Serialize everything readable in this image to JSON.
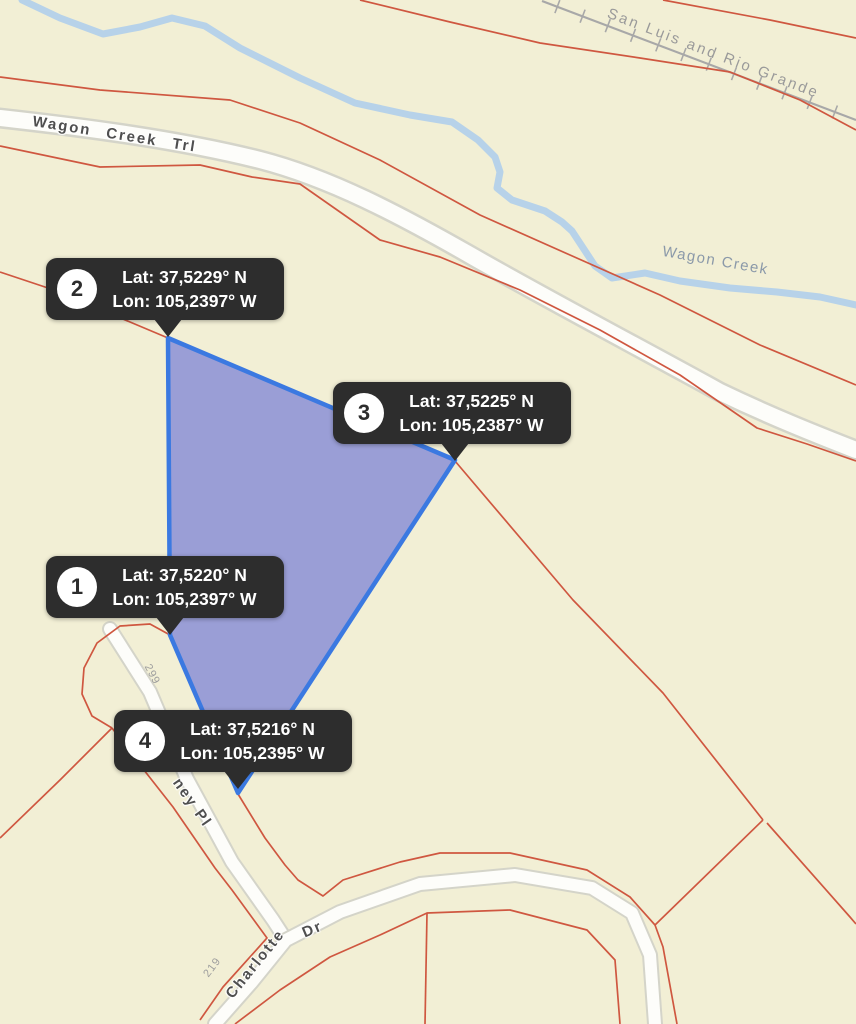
{
  "map_labels": {
    "railroad": "San Luis and Rio Grande",
    "main_road": "Wagon Creek Trl",
    "creek": "Wagon Creek",
    "address_299": "299",
    "address_219": "219",
    "road_ney_pl": "ney Pl",
    "road_charlotte": "Charlotte",
    "road_charlotte_suffix": "Dr"
  },
  "markers": [
    {
      "number": "1",
      "lat": "Lat: 37,5220° N",
      "lon": "Lon: 105,2397° W"
    },
    {
      "number": "2",
      "lat": "Lat: 37,5229° N",
      "lon": "Lon: 105,2397° W"
    },
    {
      "number": "3",
      "lat": "Lat: 37,5225° N",
      "lon": "Lon: 105,2387° W"
    },
    {
      "number": "4",
      "lat": "Lat: 37,5216° N",
      "lon": "Lon: 105,2395° W"
    }
  ],
  "colors": {
    "background": "#f2efd5",
    "parcel_line": "#cf5740",
    "selected_parcel_fill": "#939ade",
    "selected_parcel_stroke": "#3b79e1",
    "creek": "#b7d2e9",
    "road_fill": "#fdfdfa",
    "railroad": "#a8a8a8",
    "tooltip_background": "#2d2d2d"
  }
}
